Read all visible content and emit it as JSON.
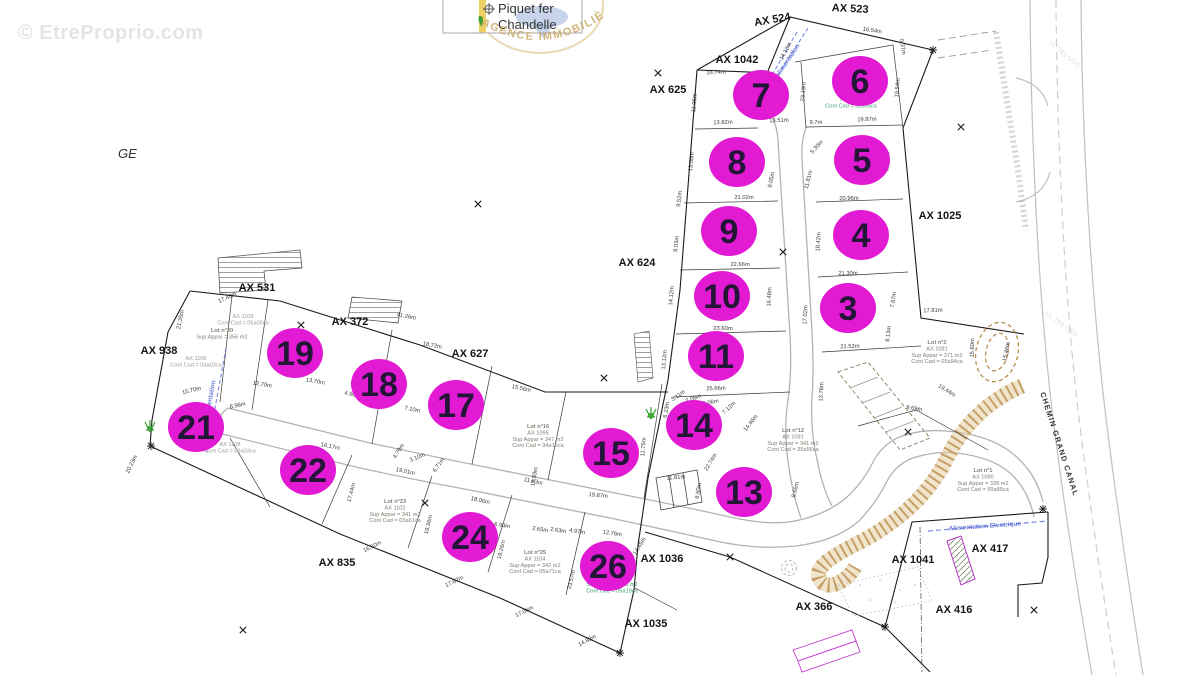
{
  "watermark": "© EtreProprio.com",
  "logo": {
    "name_line1": "Piquet fer",
    "name_line2": "Chandelle",
    "stamp_text": "AGENCE IMMOBILIÈRE"
  },
  "map": {
    "region_label": "GE",
    "road_name": "CHEMIN GRAND CANAL",
    "colors": {
      "lot_marker": "#e31ad4",
      "lot_number": "#221536",
      "parcel_label": "#151515",
      "measurement": "#1a1a1a",
      "info_green": "#3f9e74",
      "info_gray": "#857b72",
      "info_lgray": "#9a9a9a",
      "blue_utility": "#4a5fd0",
      "talus": "#b98e4e",
      "street": "#b2b2b2"
    },
    "lot_markers": [
      {
        "n": "7",
        "x": 761,
        "y": 95
      },
      {
        "n": "6",
        "x": 860,
        "y": 81
      },
      {
        "n": "8",
        "x": 737,
        "y": 162
      },
      {
        "n": "5",
        "x": 862,
        "y": 160
      },
      {
        "n": "9",
        "x": 729,
        "y": 231
      },
      {
        "n": "4",
        "x": 861,
        "y": 235
      },
      {
        "n": "10",
        "x": 722,
        "y": 296
      },
      {
        "n": "3",
        "x": 848,
        "y": 308
      },
      {
        "n": "11",
        "x": 716,
        "y": 356
      },
      {
        "n": "14",
        "x": 694,
        "y": 425
      },
      {
        "n": "15",
        "x": 611,
        "y": 453
      },
      {
        "n": "13",
        "x": 744,
        "y": 492
      },
      {
        "n": "19",
        "x": 295,
        "y": 353
      },
      {
        "n": "18",
        "x": 379,
        "y": 384
      },
      {
        "n": "17",
        "x": 456,
        "y": 405
      },
      {
        "n": "21",
        "x": 196,
        "y": 427
      },
      {
        "n": "22",
        "x": 308,
        "y": 470
      },
      {
        "n": "24",
        "x": 470,
        "y": 537
      },
      {
        "n": "26",
        "x": 608,
        "y": 566
      }
    ],
    "parcel_labels": [
      {
        "t": "AX 524",
        "x": 773,
        "y": 23,
        "r": -10
      },
      {
        "t": "AX 523",
        "x": 850,
        "y": 12,
        "r": 3
      },
      {
        "t": "AX 1042",
        "x": 737,
        "y": 63,
        "r": 0
      },
      {
        "t": "AX 625",
        "x": 668,
        "y": 93,
        "r": 0
      },
      {
        "t": "AX 624",
        "x": 637,
        "y": 266,
        "r": 0
      },
      {
        "t": "AX 1025",
        "x": 940,
        "y": 219,
        "r": 0
      },
      {
        "t": "AX 531",
        "x": 257,
        "y": 291,
        "r": 0
      },
      {
        "t": "AX 372",
        "x": 350,
        "y": 325,
        "r": 0
      },
      {
        "t": "AX 627",
        "x": 470,
        "y": 357,
        "r": 0
      },
      {
        "t": "AX 938",
        "x": 159,
        "y": 354,
        "r": 0
      },
      {
        "t": "AX 835",
        "x": 337,
        "y": 566,
        "r": 0
      },
      {
        "t": "AX 1036",
        "x": 662,
        "y": 562,
        "r": 0
      },
      {
        "t": "AX 1035",
        "x": 646,
        "y": 627,
        "r": 0
      },
      {
        "t": "AX 366",
        "x": 814,
        "y": 610,
        "r": 0
      },
      {
        "t": "AX 1041",
        "x": 913,
        "y": 563,
        "r": 0
      },
      {
        "t": "AX 416",
        "x": 954,
        "y": 613,
        "r": 0
      },
      {
        "t": "AX 417",
        "x": 990,
        "y": 552,
        "r": 0
      }
    ],
    "measurements": [
      {
        "t": "16.74m",
        "x": 716,
        "y": 74,
        "r": -2
      },
      {
        "t": "14.13m",
        "x": 787,
        "y": 52,
        "r": -62
      },
      {
        "t": "16.54m",
        "x": 872,
        "y": 32,
        "r": 9
      },
      {
        "t": "0.37m",
        "x": 901,
        "y": 47,
        "r": 80
      },
      {
        "t": "23.19m",
        "x": 805,
        "y": 92,
        "r": -85
      },
      {
        "t": "19.54m",
        "x": 899,
        "y": 88,
        "r": -85
      },
      {
        "t": "11.95m",
        "x": 696,
        "y": 103,
        "r": -85
      },
      {
        "t": "13.82m",
        "x": 723,
        "y": 124,
        "r": -2
      },
      {
        "t": "13.51m",
        "x": 779,
        "y": 122,
        "r": -2
      },
      {
        "t": "9.7m",
        "x": 816,
        "y": 124,
        "r": -2
      },
      {
        "t": "19.87m",
        "x": 867,
        "y": 121,
        "r": -2
      },
      {
        "t": "13.05m",
        "x": 693,
        "y": 162,
        "r": -84
      },
      {
        "t": "8.05m",
        "x": 773,
        "y": 180,
        "r": -78
      },
      {
        "t": "5.30m",
        "x": 818,
        "y": 148,
        "r": -48
      },
      {
        "t": "11.81m",
        "x": 810,
        "y": 180,
        "r": -76
      },
      {
        "t": "17.43m",
        "x": 889,
        "y": 162,
        "r": -85
      },
      {
        "t": "21.02m",
        "x": 744,
        "y": 199,
        "r": 0
      },
      {
        "t": "20.96m",
        "x": 849,
        "y": 200,
        "r": -1
      },
      {
        "t": "9.52m",
        "x": 681,
        "y": 199,
        "r": -84
      },
      {
        "t": "8.03m",
        "x": 678,
        "y": 244,
        "r": -84
      },
      {
        "t": "18.42m",
        "x": 820,
        "y": 242,
        "r": -86
      },
      {
        "t": "22.66m",
        "x": 740,
        "y": 266,
        "r": 0
      },
      {
        "t": "21.30m",
        "x": 848,
        "y": 275,
        "r": -1
      },
      {
        "t": "14.12m",
        "x": 673,
        "y": 296,
        "r": -85
      },
      {
        "t": "16.48m",
        "x": 771,
        "y": 297,
        "r": -87
      },
      {
        "t": "17.02m",
        "x": 807,
        "y": 315,
        "r": -87
      },
      {
        "t": "7.67m",
        "x": 895,
        "y": 300,
        "r": -80
      },
      {
        "t": "23.60m",
        "x": 723,
        "y": 330,
        "r": 0
      },
      {
        "t": "21.52m",
        "x": 850,
        "y": 348,
        "r": -2
      },
      {
        "t": "8.13m",
        "x": 890,
        "y": 334,
        "r": -84
      },
      {
        "t": "13.12m",
        "x": 666,
        "y": 360,
        "r": -85
      },
      {
        "t": "13.78m",
        "x": 823,
        "y": 392,
        "r": -87
      },
      {
        "t": "25.66m",
        "x": 716,
        "y": 390,
        "r": -2
      },
      {
        "t": "17.81m",
        "x": 933,
        "y": 312,
        "r": -2
      },
      {
        "t": "15.60m",
        "x": 974,
        "y": 348,
        "r": -88
      },
      {
        "t": "19.44m",
        "x": 946,
        "y": 392,
        "r": 32
      },
      {
        "t": "9.69m",
        "x": 914,
        "y": 410,
        "r": 8
      },
      {
        "t": "15.46m",
        "x": 1008,
        "y": 352,
        "r": -78
      },
      {
        "t": "3.11m",
        "x": 679,
        "y": 397,
        "r": -35
      },
      {
        "t": "3.06m",
        "x": 694,
        "y": 400,
        "r": -20
      },
      {
        "t": "6.06m",
        "x": 711,
        "y": 404,
        "r": -12
      },
      {
        "t": "7.12m",
        "x": 730,
        "y": 409,
        "r": -42
      },
      {
        "t": "6.23m",
        "x": 668,
        "y": 410,
        "r": -80
      },
      {
        "t": "14.46m",
        "x": 752,
        "y": 424,
        "r": -52
      },
      {
        "t": "22.74m",
        "x": 712,
        "y": 463,
        "r": -58
      },
      {
        "t": "8.66m",
        "x": 797,
        "y": 490,
        "r": -76
      },
      {
        "t": "11.81m",
        "x": 676,
        "y": 479,
        "r": -4
      },
      {
        "t": "8.60m",
        "x": 700,
        "y": 491,
        "r": -80
      },
      {
        "t": "14.45m",
        "x": 641,
        "y": 547,
        "r": -58
      },
      {
        "t": "17.48m",
        "x": 228,
        "y": 299,
        "r": -25
      },
      {
        "t": "21.35m",
        "x": 182,
        "y": 320,
        "r": -78
      },
      {
        "t": "41.26m",
        "x": 406,
        "y": 318,
        "r": 11
      },
      {
        "t": "18.72m",
        "x": 432,
        "y": 347,
        "r": 11
      },
      {
        "t": "15.56m",
        "x": 521,
        "y": 390,
        "r": 12
      },
      {
        "t": "12.70m",
        "x": 262,
        "y": 386,
        "r": 10
      },
      {
        "t": "13.70m",
        "x": 315,
        "y": 383,
        "r": 10
      },
      {
        "t": "4.90m",
        "x": 352,
        "y": 396,
        "r": 12
      },
      {
        "t": "5.13m",
        "x": 383,
        "y": 403,
        "r": 12
      },
      {
        "t": "7.10m",
        "x": 412,
        "y": 411,
        "r": 12
      },
      {
        "t": "15.70m",
        "x": 192,
        "y": 392,
        "r": -14
      },
      {
        "t": "20.23m",
        "x": 133,
        "y": 465,
        "r": -64
      },
      {
        "t": "8.96m",
        "x": 238,
        "y": 407,
        "r": -12
      },
      {
        "t": "4.79m",
        "x": 400,
        "y": 452,
        "r": -58
      },
      {
        "t": "3.10m",
        "x": 418,
        "y": 459,
        "r": -22
      },
      {
        "t": "6.71m",
        "x": 440,
        "y": 466,
        "r": -55
      },
      {
        "t": "16.17m",
        "x": 330,
        "y": 448,
        "r": 12
      },
      {
        "t": "19.01m",
        "x": 405,
        "y": 473,
        "r": 12
      },
      {
        "t": "18.06m",
        "x": 480,
        "y": 502,
        "r": 12
      },
      {
        "t": "11.83m",
        "x": 533,
        "y": 483,
        "r": 12
      },
      {
        "t": "17.93m",
        "x": 536,
        "y": 477,
        "r": -80
      },
      {
        "t": "11.75m",
        "x": 645,
        "y": 447,
        "r": -85
      },
      {
        "t": "19.87m",
        "x": 598,
        "y": 497,
        "r": 6
      },
      {
        "t": "17.44m",
        "x": 353,
        "y": 493,
        "r": -76
      },
      {
        "t": "19.36m",
        "x": 430,
        "y": 525,
        "r": -76
      },
      {
        "t": "19.26m",
        "x": 503,
        "y": 550,
        "r": -76
      },
      {
        "t": "23.57m",
        "x": 573,
        "y": 580,
        "r": -76
      },
      {
        "t": "16.50m",
        "x": 373,
        "y": 548,
        "r": -26
      },
      {
        "t": "17.67m",
        "x": 455,
        "y": 583,
        "r": -26
      },
      {
        "t": "17.06m",
        "x": 525,
        "y": 613,
        "r": -26
      },
      {
        "t": "14.83m",
        "x": 588,
        "y": 642,
        "r": -28
      },
      {
        "t": "6.93m",
        "x": 502,
        "y": 527,
        "r": 9
      },
      {
        "t": "2.65m",
        "x": 540,
        "y": 531,
        "r": 9
      },
      {
        "t": "2.63m",
        "x": 558,
        "y": 532,
        "r": 9
      },
      {
        "t": "4.97m",
        "x": 577,
        "y": 533,
        "r": 9
      },
      {
        "t": "12.76m",
        "x": 612,
        "y": 535,
        "r": 8
      }
    ],
    "info_blocks": [
      {
        "x": 851,
        "y": 101,
        "color": "green",
        "lines": [
          "AX 1043",
          "Cont Cad = 32a65ca"
        ]
      },
      {
        "x": 937,
        "y": 344,
        "color": "gray",
        "lines": [
          "Lot n°2",
          "AX 1081",
          "Sup Appar = 371 m2",
          "Cont Cad = 05a94ca"
        ]
      },
      {
        "x": 983,
        "y": 472,
        "color": "gray",
        "lines": [
          "Lot n°1",
          "AX 1080",
          "Sup Appar = 339 m2",
          "Cont Cad = 99a85ca"
        ]
      },
      {
        "x": 793,
        "y": 432,
        "color": "gray",
        "lines": [
          "Lot n°12",
          "AX 1091",
          "Sup Appar = 341 m2",
          "Cont Cad = 35a56ca"
        ]
      },
      {
        "x": 538,
        "y": 428,
        "color": "gray",
        "lines": [
          "Lot n°16",
          "AX 1095",
          "Sup Appar = 347 m2",
          "Cont Cad = 94a15ca"
        ]
      },
      {
        "x": 395,
        "y": 503,
        "color": "gray",
        "lines": [
          "Lot n°23",
          "AX 1102",
          "Sup Appar = 341 m2",
          "Cont Cad = 03a61ca"
        ]
      },
      {
        "x": 535,
        "y": 554,
        "color": "gray",
        "lines": [
          "Lot n°25",
          "AX 1104",
          "Sup Appar = 342 m2",
          "Cont Cad = 05a71ca"
        ]
      },
      {
        "x": 612,
        "y": 586,
        "color": "green",
        "lines": [
          "Sup Appar = 346 m2",
          "Cont Cad = 05a19ca"
        ]
      },
      {
        "x": 222,
        "y": 332,
        "color": "gray",
        "lines": [
          "Lot n°20",
          "Sup Appar = 356 m2"
        ]
      },
      {
        "x": 243,
        "y": 318,
        "color": "lgray",
        "lines": [
          "AX 1109",
          "Cont Cad = 05a05ca"
        ]
      },
      {
        "x": 196,
        "y": 360,
        "color": "lgray",
        "lines": [
          "AX 1106",
          "Cont Cad = 03a03ca"
        ]
      },
      {
        "x": 230,
        "y": 446,
        "color": "lgray",
        "lines": [
          "AX 1108",
          "Cont Cad = 03a03ca"
        ]
      }
    ],
    "utility_notes": [
      {
        "t": "Alimentation",
        "x": 789,
        "y": 62,
        "r": -56
      },
      {
        "t": "Alimentation",
        "x": 212,
        "y": 400,
        "r": -80
      },
      {
        "t": "Alimentation Electrique",
        "x": 985,
        "y": 528,
        "r": -4
      }
    ],
    "faint_labels": [
      {
        "t": "VL 789 USS",
        "x": 1063,
        "y": 56,
        "r": 38
      },
      {
        "t": "VL 789 USS",
        "x": 1060,
        "y": 326,
        "r": 36
      }
    ],
    "x_marks": [
      {
        "x": 658,
        "y": 73
      },
      {
        "x": 961,
        "y": 127
      },
      {
        "x": 478,
        "y": 204
      },
      {
        "x": 301,
        "y": 325
      },
      {
        "x": 783,
        "y": 252
      },
      {
        "x": 604,
        "y": 378
      },
      {
        "x": 908,
        "y": 432
      },
      {
        "x": 425,
        "y": 503
      },
      {
        "x": 730,
        "y": 557
      },
      {
        "x": 243,
        "y": 630
      },
      {
        "x": 1034,
        "y": 610
      }
    ],
    "star_marks": [
      {
        "x": 620,
        "y": 653
      },
      {
        "x": 885,
        "y": 627
      },
      {
        "x": 933,
        "y": 50
      },
      {
        "x": 151,
        "y": 446
      },
      {
        "x": 1043,
        "y": 509
      }
    ],
    "trees": [
      {
        "x": 150,
        "y": 430
      },
      {
        "x": 651,
        "y": 417
      }
    ]
  }
}
